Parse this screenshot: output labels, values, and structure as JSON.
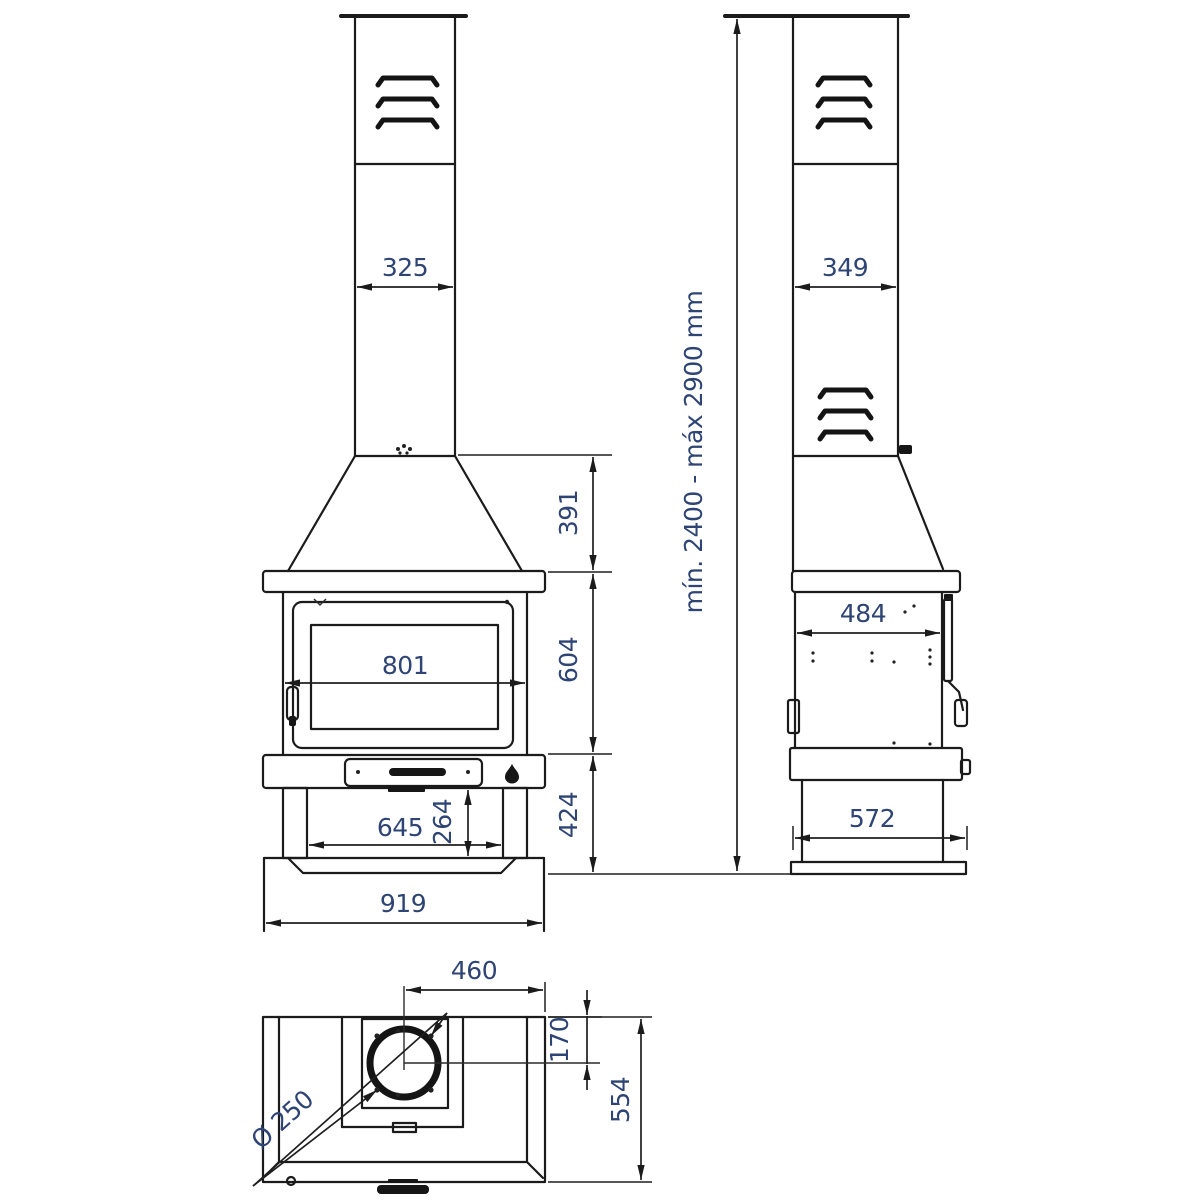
{
  "drawing": {
    "front_view": {
      "dims": {
        "chimney_width": "325",
        "hood_height": "391",
        "door_width": "801",
        "firebox_height": "604",
        "base_height": "424",
        "inner_width": "645",
        "leg_space_height": "264",
        "total_width": "919"
      }
    },
    "side_view": {
      "dims": {
        "chimney_depth": "349",
        "body_depth": "484",
        "base_depth": "572",
        "height_range": "mín. 2400 - máx 2900 mm"
      }
    },
    "top_view": {
      "dims": {
        "flue_center_from_right": "460",
        "flue_center_from_back": "170",
        "total_depth": "554",
        "flue_diameter": "Ø 250"
      }
    },
    "colors": {
      "line": "#1b1b1b",
      "dim_text": "#2e4474",
      "background": "#ffffff"
    }
  }
}
